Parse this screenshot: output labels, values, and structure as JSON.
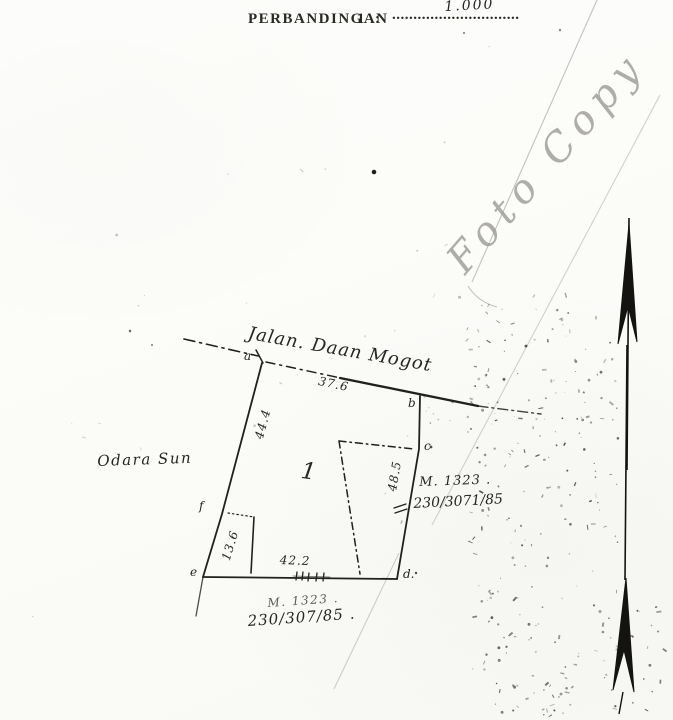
{
  "header": {
    "scale_label": "PERBANDINGAN",
    "scale_number": "1",
    "colon": ":",
    "dotted_leader": "..............................",
    "scale_value_handwritten": "1.000"
  },
  "stamp": {
    "foto_copy": "Foto Copy"
  },
  "map": {
    "street_name": "Jalan. Daan Mogot",
    "neighbor_label": "Odara Sun",
    "parcel_number": "1",
    "corners": {
      "a": "a",
      "b": "b",
      "c": "c",
      "d": "d.",
      "e": "e",
      "f": "f"
    },
    "measurements": {
      "top": "37.6",
      "left": "44.4",
      "right": "48.5",
      "bottom": "42.2",
      "left_lower": "13.6"
    },
    "annotation_right": {
      "line1": "M. 1323 .",
      "line2": "230/3071/85"
    },
    "annotation_bottom": {
      "line1": "M. 1323 .",
      "line2": "230/307/85 ."
    }
  },
  "colors": {
    "ink": "#21201d",
    "pencil": "#9b9a96",
    "crease": "#c3c2bc",
    "paper": "#fbfbf8"
  }
}
